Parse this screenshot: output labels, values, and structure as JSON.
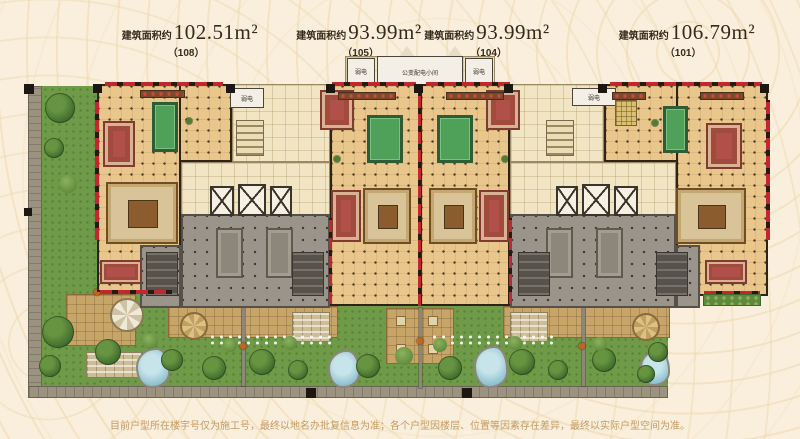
{
  "header": {
    "units": [
      {
        "prefix": "建筑面积约",
        "area": "102.51m²",
        "code": "（108）"
      },
      {
        "prefix": "建筑面积约",
        "area": "93.99m²",
        "code": "（105）"
      },
      {
        "prefix": "建筑面积约",
        "area": "93.99m²",
        "code": "（104）"
      },
      {
        "prefix": "建筑面积约",
        "area": "106.79m²",
        "code": "（101）"
      }
    ]
  },
  "plan": {
    "room_labels": {
      "weak_current": "弱电",
      "transformer_room": "公变配电小间"
    }
  },
  "footer": {
    "disclaimer": "目前户型所在楼宇号仅为施工号，最终以地名办批复信息为准；各个户型因楼层、位置等因素存在差异，最终以实际户型空间为准。"
  },
  "colors": {
    "background": "#f9efdc",
    "floor_tan": "#e9c78c",
    "pool_table_green": "#4fa058",
    "terrace_gray": "#9a948a",
    "garden_green": "#6f9a48",
    "pond_blue": "#96c8d6",
    "accent_wall_red": "#c1272d",
    "core_cream": "#f1e5c3",
    "label_text": "#352a1c",
    "disclaimer_text": "#c59a64"
  }
}
